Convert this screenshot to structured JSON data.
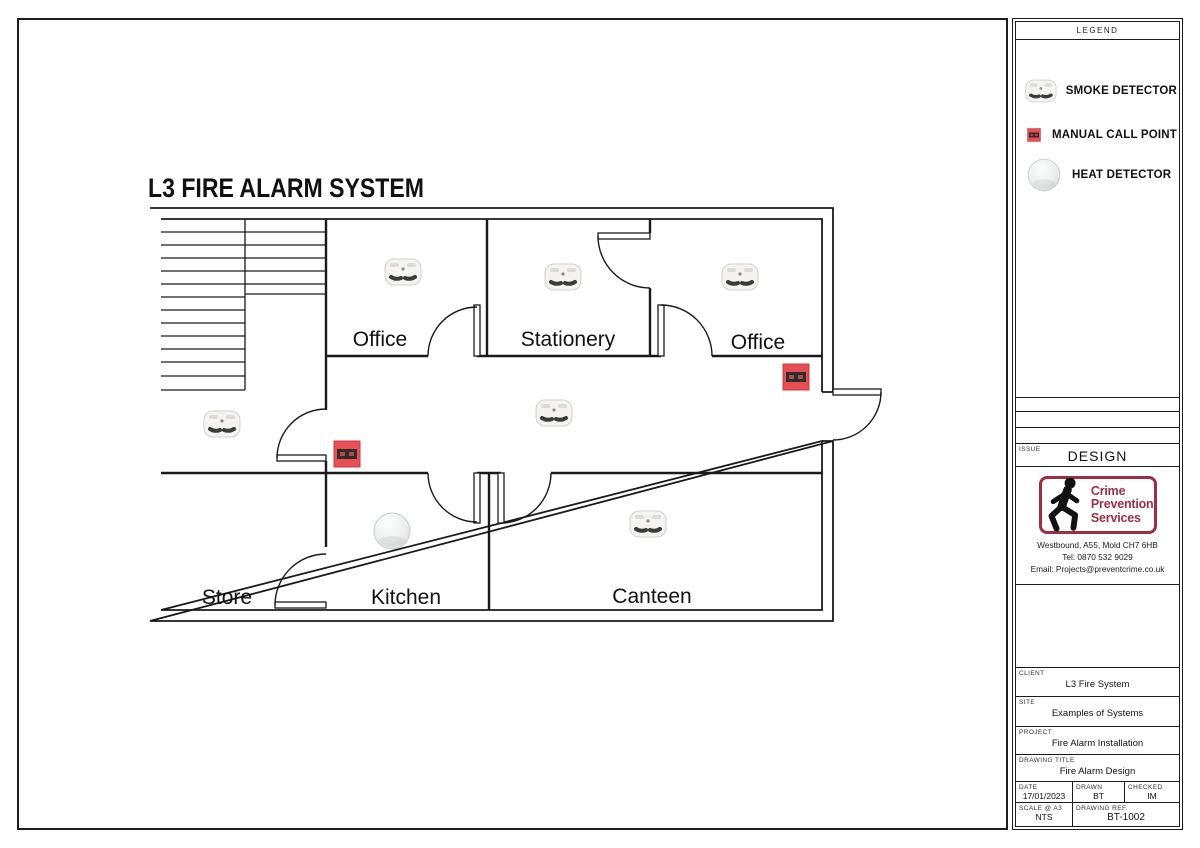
{
  "drawing": {
    "title": "L3 FIRE ALARM SYSTEM",
    "rooms": [
      {
        "name": "Office"
      },
      {
        "name": "Stationery"
      },
      {
        "name": "Office"
      },
      {
        "name": "Store"
      },
      {
        "name": "Kitchen"
      },
      {
        "name": "Canteen"
      }
    ],
    "devices": [
      {
        "type": "smoke",
        "location": "office-left",
        "x": 403,
        "y": 272
      },
      {
        "type": "smoke",
        "location": "stationery",
        "x": 563,
        "y": 277
      },
      {
        "type": "smoke",
        "location": "office-right",
        "x": 740,
        "y": 277
      },
      {
        "type": "smoke",
        "location": "hall",
        "x": 222,
        "y": 424
      },
      {
        "type": "smoke",
        "location": "corridor",
        "x": 554,
        "y": 413
      },
      {
        "type": "smoke",
        "location": "canteen",
        "x": 648,
        "y": 524
      },
      {
        "type": "heat",
        "location": "kitchen",
        "x": 392,
        "y": 531
      },
      {
        "type": "mcp",
        "location": "corridor",
        "x": 347,
        "y": 454
      },
      {
        "type": "mcp",
        "location": "exit",
        "x": 796,
        "y": 377
      }
    ]
  },
  "legend": {
    "header": "LEGEND",
    "items": [
      {
        "type": "smoke",
        "label": "SMOKE DETECTOR"
      },
      {
        "type": "mcp",
        "label": "MANUAL CALL POINT"
      },
      {
        "type": "heat",
        "label": "HEAT DETECTOR"
      }
    ]
  },
  "title_block": {
    "issue_label": "ISSUE",
    "issue_value": "DESIGN",
    "company": {
      "name_line1": "Crime",
      "name_line2": "Prevention",
      "name_line3": "Services",
      "address": "Westbound, A55, Mold CH7 6HB",
      "tel": "Tel: 0870 532 9029",
      "email": "Email: Projects@preventcrime.co.uk"
    },
    "client_label": "CLIENT",
    "client": "L3 Fire System",
    "site_label": "SITE",
    "site": "Examples of Systems",
    "project_label": "PROJECT",
    "project": "Fire Alarm Installation",
    "drawing_title_label": "DRAWING TITLE",
    "drawing_title": "Fire Alarm Design",
    "date_label": "DATE",
    "date": "17/01/2023",
    "drawn_label": "DRAWN",
    "drawn": "BT",
    "checked_label": "CHECKED",
    "checked": "IM",
    "scale_label": "SCALE @ A3",
    "scale": "NTS",
    "ref_label": "DRAWING REF.",
    "ref": "BT-1002"
  },
  "colors": {
    "mcp_red": "#e84f55",
    "logo_red": "#9e2f42",
    "line": "#1a1a1a"
  }
}
